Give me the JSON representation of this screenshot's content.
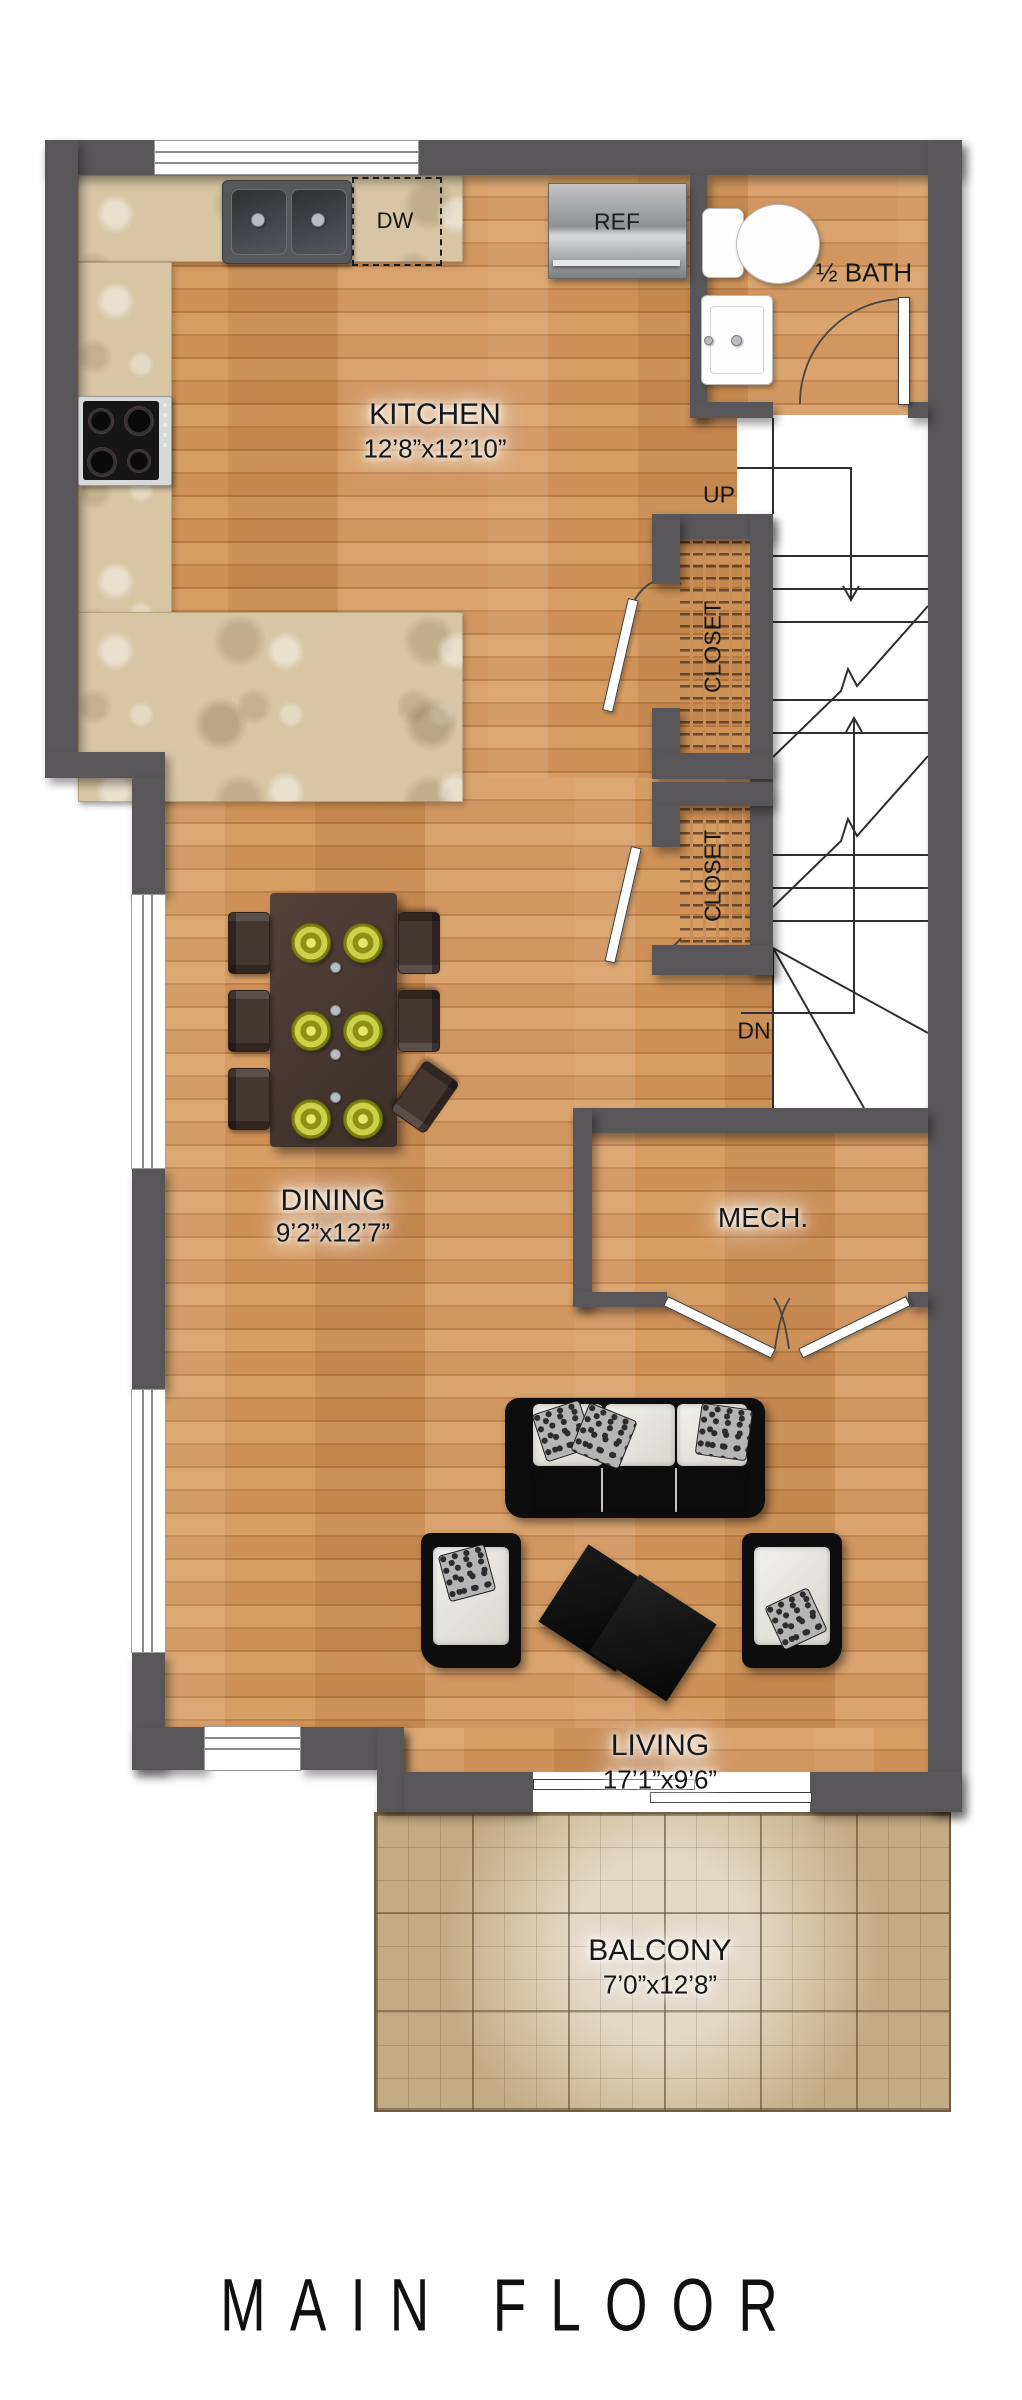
{
  "title": "MAIN FLOOR",
  "rooms": {
    "kitchen": {
      "name": "KITCHEN",
      "dims": "12’8”x12’10”"
    },
    "bath": {
      "name": "½ BATH"
    },
    "dining": {
      "name": "DINING",
      "dims": "9’2”x12’7”"
    },
    "mech": {
      "name": "MECH."
    },
    "living": {
      "name": "LIVING",
      "dims": "17’1”x9’6”"
    },
    "balcony": {
      "name": "BALCONY",
      "dims": "7’0”x12’8”"
    }
  },
  "stairs": {
    "up": "UP",
    "down": "DN"
  },
  "closets": [
    {
      "label": "CLOSET"
    },
    {
      "label": "CLOSET"
    }
  ],
  "appliances": {
    "dishwasher": "DW",
    "refrigerator": "REF"
  },
  "colors": {
    "wall": "#585659",
    "wood_floor": "#cb9257",
    "granite_counter": "#d7c5a4",
    "balcony_tile": "#c3ab83",
    "furniture_black": "#0d0d0d",
    "plate_green": "#b9bd2e"
  }
}
